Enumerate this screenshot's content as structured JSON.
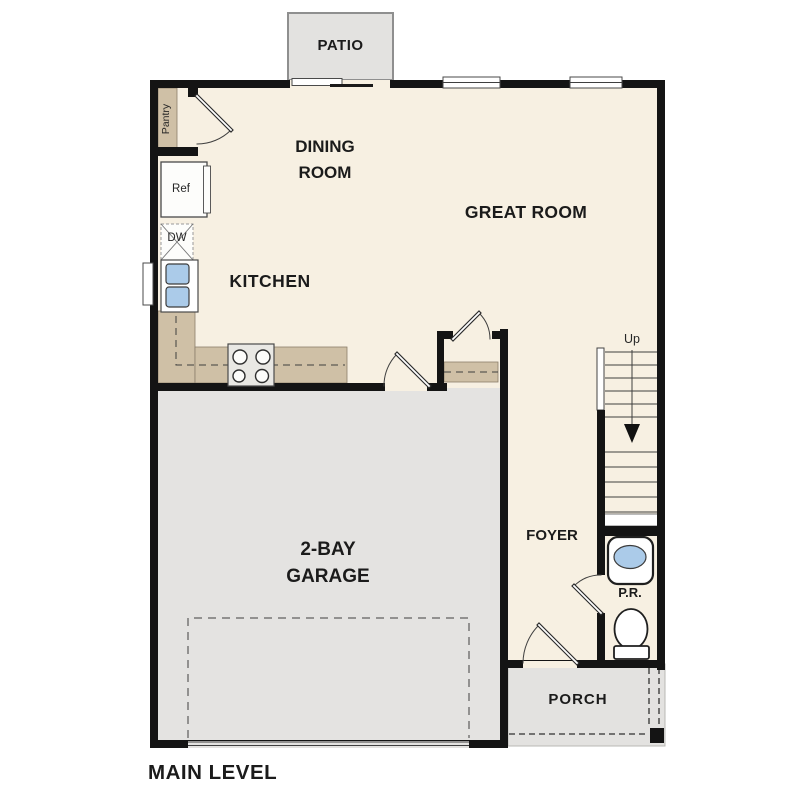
{
  "plan_title": "MAIN LEVEL",
  "rooms": {
    "patio": "PATIO",
    "dining_room": "DINING ROOM",
    "great_room": "GREAT ROOM",
    "kitchen": "KITCHEN",
    "garage": "2-BAY GARAGE",
    "foyer": "FOYER",
    "powder_room": "P.R.",
    "porch": "PORCH"
  },
  "fixtures": {
    "pantry": "Pantry",
    "refrigerator": "Ref",
    "dishwasher": "DW",
    "stairs_direction": "Up"
  },
  "colors": {
    "floor": "#f7f0e2",
    "garage": "#e4e3e1",
    "outdoor": "#e3e2e0",
    "counter": "#cfc0a6",
    "sink": "#abcbe9",
    "wall": "#141414"
  }
}
